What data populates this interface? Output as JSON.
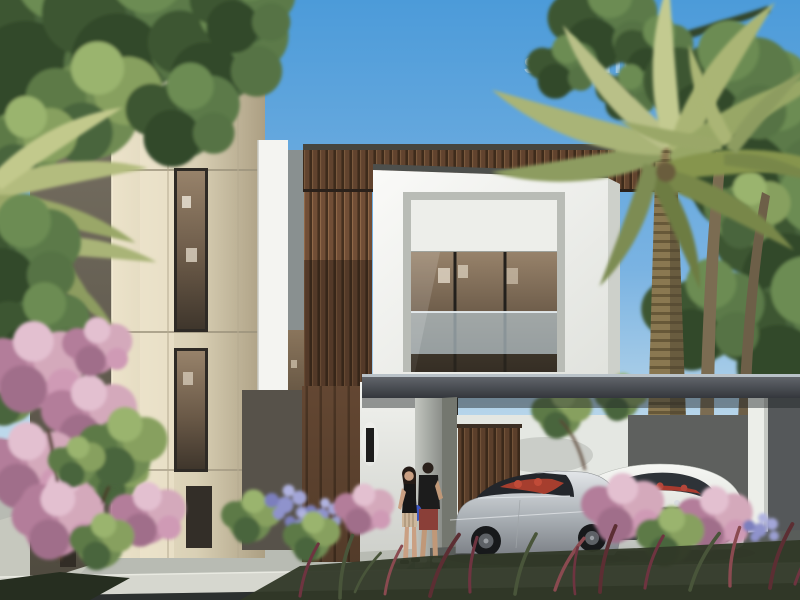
{
  "watermark": {
    "text": "salesnlease.com",
    "color": "#ffffff",
    "opacity": 0.42
  },
  "scene": {
    "type": "architectural-render",
    "alt": "Photorealistic rendering of a modern two-storey villa: beige stone tower, white cubic volume with a large glass window, vertical timber slat cladding, flat carport canopy sheltering a silver sports coupe and a white luxury coupe, a couple walking toward the entrance, date palms, flowering shrubs and a clear blue sky.",
    "palette": {
      "sky_top": "#4c9bd9",
      "sky_horizon": "#d6e6f0",
      "stone_lit": "#ece3ca",
      "stone_shade": "#4f4a3f",
      "timber": "#714e36",
      "white_wall": "#f4f5f1",
      "glass_interior": "#6b5a48",
      "balustrade_glass": "#b7c6cd",
      "canopy_grey": "#45484e",
      "driveway": "#8f938f",
      "curb": "#d6d7cf",
      "asphalt": "#2c302f",
      "palm_frond": "#a9b477",
      "tree_green": "#4a653c",
      "bloom_pink": "#cf9ab5",
      "bloom_purple": "#8f93cc",
      "car_silver": "#c3c7cb",
      "car_white": "#eceeeb",
      "car_interior_red": "#b2402f"
    },
    "elements": [
      "sky",
      "watermark",
      "left-tree",
      "left-palm",
      "bougainvillea",
      "stone-tower",
      "timber-slat-band",
      "white-box-volume",
      "picture-window",
      "entrance-door",
      "wall-sconce",
      "carport-canopy",
      "carport-column",
      "date-palm",
      "background-houses",
      "silver-sports-car",
      "white-luxury-car",
      "walking-couple",
      "fountain-grass",
      "agapanthus",
      "driveway",
      "curb",
      "road"
    ]
  }
}
